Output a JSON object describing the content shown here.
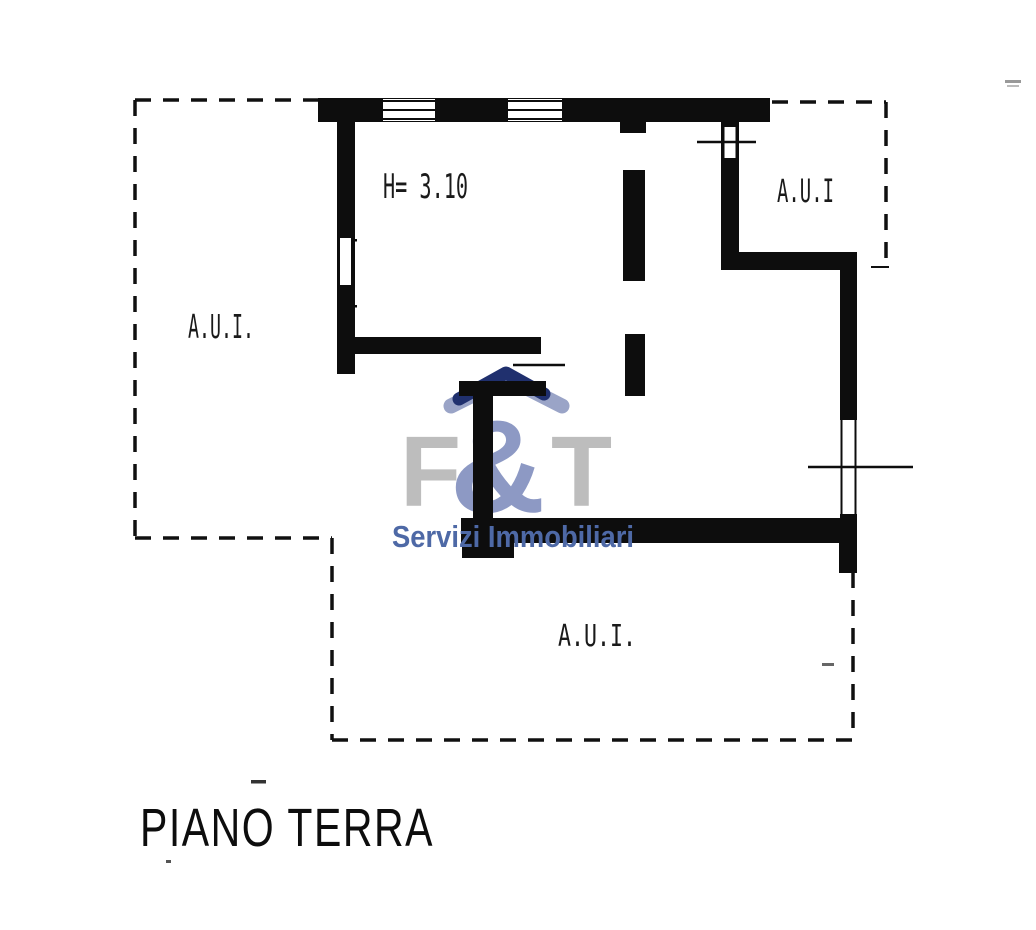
{
  "plan": {
    "floor_title": "PIANO TERRA",
    "ceiling_height_note": "H= 3.10",
    "rooms": [
      {
        "id": "left",
        "label": "A.U.I."
      },
      {
        "id": "top-right",
        "label": "A.U.I"
      },
      {
        "id": "bottom",
        "label": "A.U.I."
      }
    ],
    "ink_color": "#0d0d0d",
    "paper_color": "#ffffff"
  },
  "watermark": {
    "letter_f": "F",
    "ampersand": "&",
    "letter_t": "T",
    "tagline": "Servizi Immobiliari",
    "colors": {
      "letters_gray": "#bdbdbd",
      "ampersand_slate": "#8d99c4",
      "tagline_blue": "#4e69a6",
      "roof_navy": "#20306e",
      "roof_slate": "#9aa4c7"
    }
  }
}
